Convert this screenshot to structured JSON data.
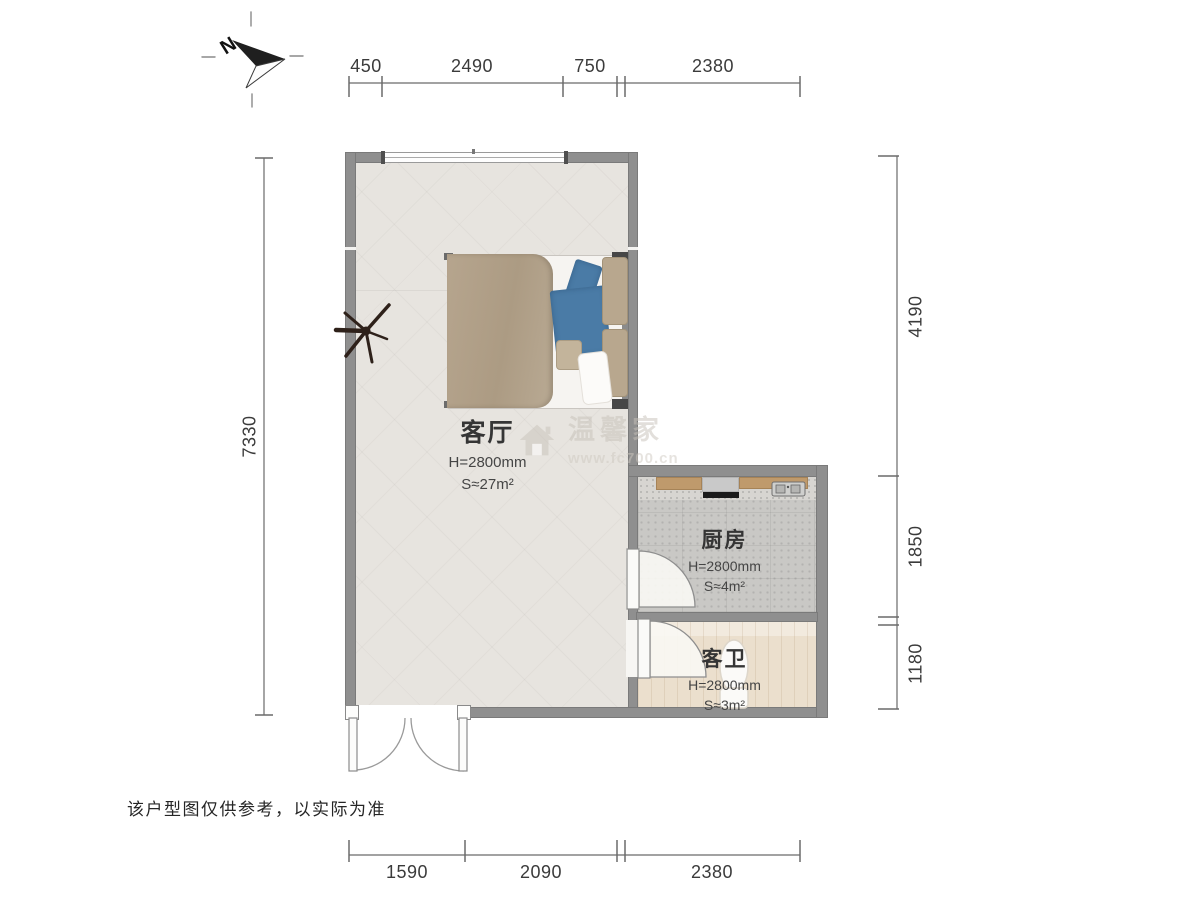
{
  "compass": {
    "north_label": "N"
  },
  "dimensions": {
    "top": [
      "450",
      "2490",
      "750",
      "2380"
    ],
    "left": [
      "7330"
    ],
    "right": [
      "4190",
      "1850",
      "1180"
    ],
    "bottom": [
      "1590",
      "2090",
      "2380"
    ]
  },
  "rooms": [
    {
      "name": "客厅",
      "height": "H=2800mm",
      "area": "S≈27m²"
    },
    {
      "name": "厨房",
      "height": "H=2800mm",
      "area": "S≈4m²"
    },
    {
      "name": "客卫",
      "height": "H=2800mm",
      "area": "S≈3m²"
    }
  ],
  "watermark": {
    "text": "温馨家",
    "url": "www.fc700.cn"
  },
  "footer": {
    "disclaimer": "该户型图仅供参考，以实际为准"
  },
  "colors": {
    "wall": "#8f8f8f",
    "living_floor": "#e7e4df",
    "kitchen_floor": "#c9c8c5",
    "bath_floor": "#ebdfcd",
    "counter": "#bf9a6c",
    "stove_bar": "#1b1b1b",
    "bed_duvet": "#b2a28b",
    "bed_blue": "#4a7ba6",
    "dimension_text": "#3b3b3b"
  }
}
